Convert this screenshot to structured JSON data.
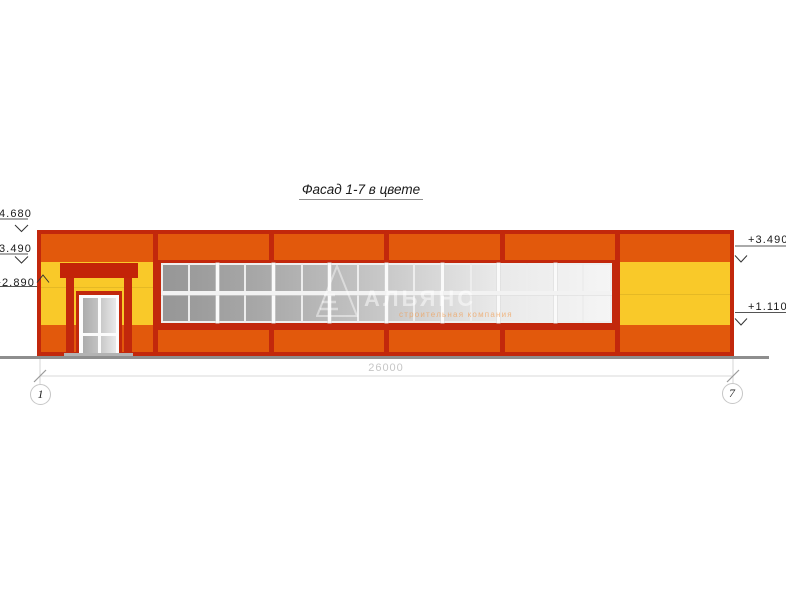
{
  "title": "Фасад 1-7 в цвете",
  "drawing": {
    "type": "facade-elevation",
    "dimension_total": "26000",
    "axis_left": "1",
    "axis_right": "7",
    "elevations": {
      "left_top": "+4.680",
      "left_mid": "+3.490",
      "left_low": "+2.890",
      "right_top": "+3.490",
      "right_low": "+1.110"
    },
    "window": {
      "columns": 16,
      "rows": 2,
      "unit_columns": 2
    }
  },
  "watermark": {
    "logo": "pyramid-logo",
    "name": "АЛЬЯНС",
    "subtitle": "строительная компания"
  },
  "colors": {
    "facade-orange": "#E2590C",
    "frame-red": "#C2280C",
    "panel-yellow": "#F9C929",
    "glass-dark": "#969696",
    "glass-light": "#F5F5F5",
    "ground-gray": "#8E8E8E",
    "dim-gray": "#C6C6C6"
  }
}
